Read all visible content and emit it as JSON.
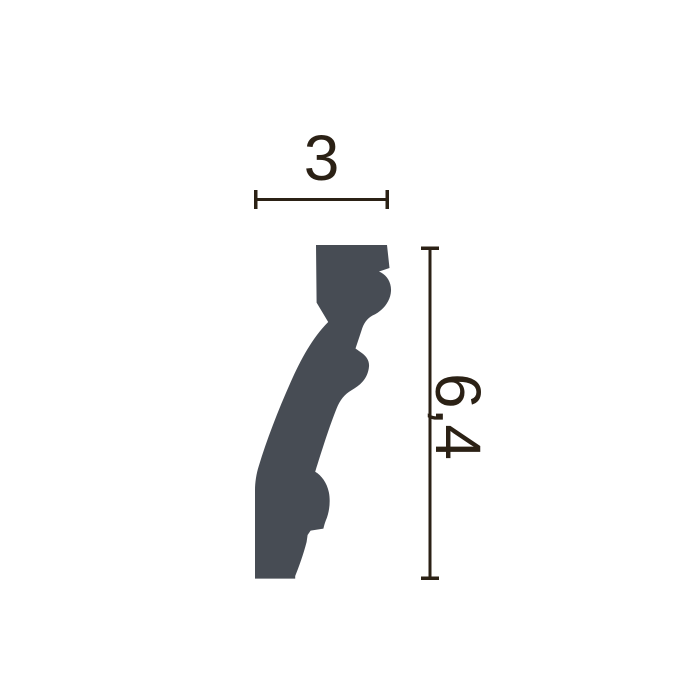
{
  "figure": {
    "background_color": "#ffffff",
    "profile_color": "#474c54",
    "dimension_color": "#2b2115",
    "dimensions": {
      "width": {
        "label": "3"
      },
      "height": {
        "label": "6,4"
      }
    }
  }
}
